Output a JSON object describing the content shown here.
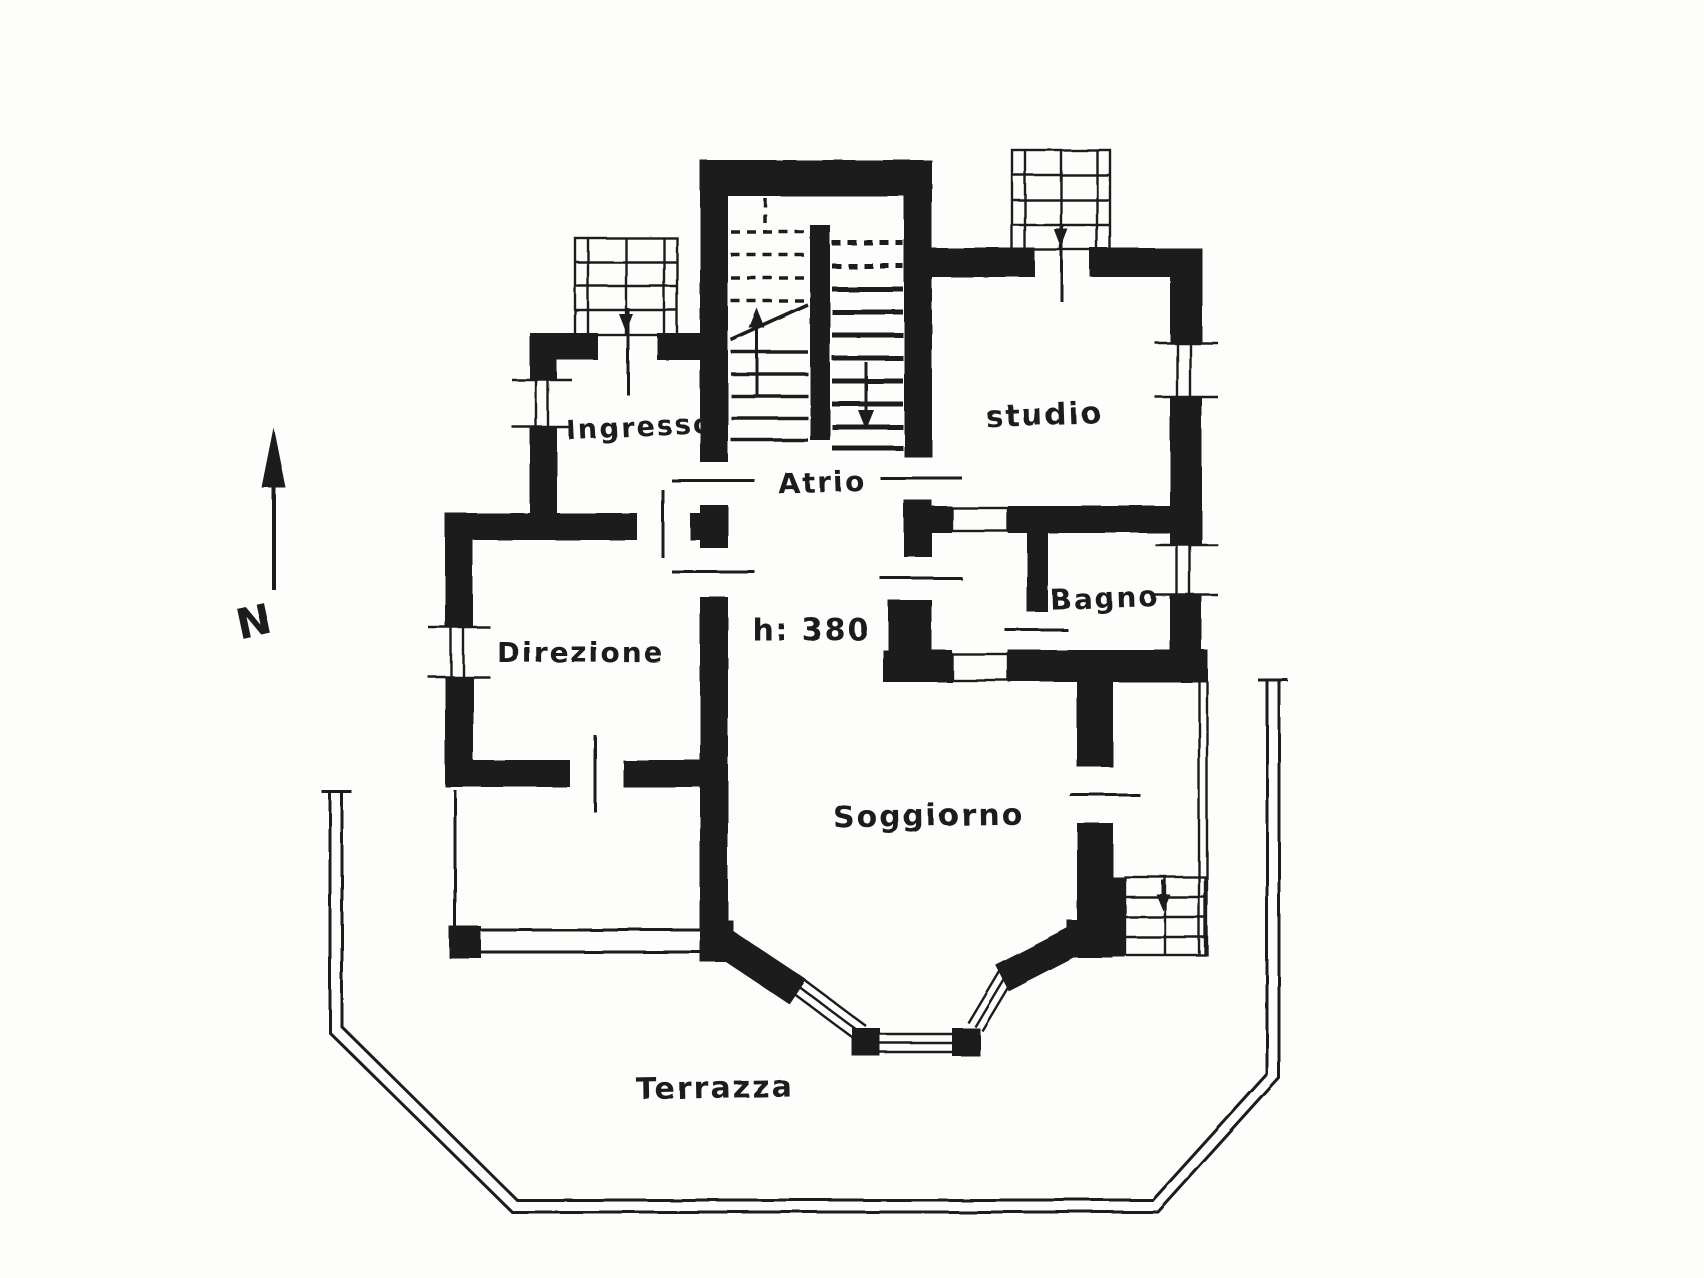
{
  "document": {
    "kind": "scanned floor plan",
    "ink_color": "#1f1f1f",
    "paper_color": "#fdfdfc",
    "compass": {
      "letter": "N"
    },
    "rooms": [
      {
        "id": "ingresso",
        "label": "Ingresso"
      },
      {
        "id": "studio",
        "label": "studio"
      },
      {
        "id": "atrio",
        "label": "Atrio"
      },
      {
        "id": "bagno",
        "label": "Bagno"
      },
      {
        "id": "direzione",
        "label": "Direzione"
      },
      {
        "id": "soggiorno",
        "label": "Soggiorno"
      },
      {
        "id": "terrazza",
        "label": "Terrazza"
      }
    ],
    "annotations": {
      "ceiling_height": "h: 380"
    }
  }
}
